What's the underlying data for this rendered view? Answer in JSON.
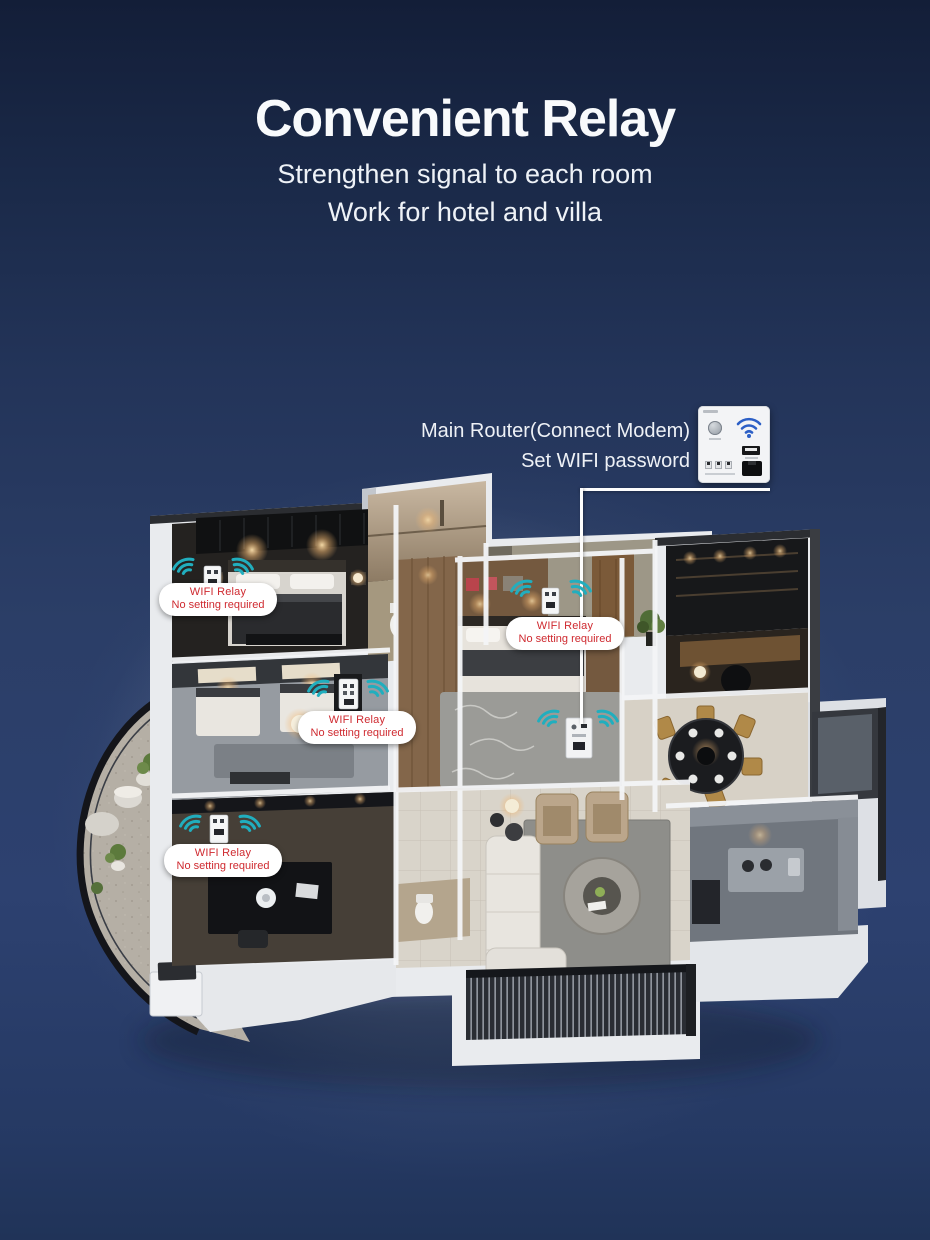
{
  "header": {
    "title": "Convenient Relay",
    "subtitle_line1": "Strengthen signal to each room",
    "subtitle_line2": "Work for hotel and villa"
  },
  "router_callout": {
    "label_line1": "Main Router(Connect Modem)",
    "label_line2": "Set WIFI password"
  },
  "floorplan": {
    "relays": [
      {
        "line1": "WIFI Relay",
        "line2": "No setting required"
      },
      {
        "line1": "WIFI Relay",
        "line2": "No setting required"
      },
      {
        "line1": "WIFI Relay",
        "line2": "No setting required"
      },
      {
        "line1": "WIFI Relay",
        "line2": "No setting required"
      }
    ]
  },
  "icons": {
    "wifi_signal": "wifi-signal-icon",
    "router_wifi": "wifi-icon",
    "usb_port": "usb-port-icon",
    "ethernet_port": "ethernet-port-icon",
    "power_button": "power-button-icon"
  },
  "colors": {
    "background_navy": "#2b3e67",
    "accent_cyan": "#21aebe",
    "label_red": "#cf2a30",
    "callout_white": "#ffffff"
  }
}
